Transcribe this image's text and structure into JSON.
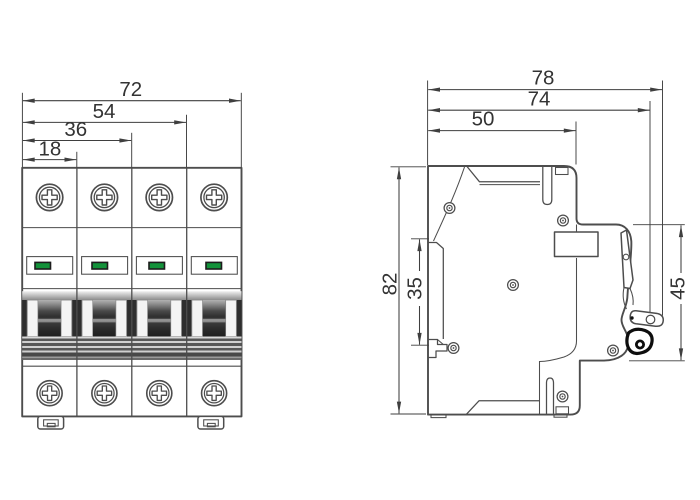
{
  "front_view": {
    "dimensions": {
      "total_width": "72",
      "three_pole_width": "54",
      "two_pole_width": "36",
      "one_pole_width": "18"
    },
    "pole_count": 4
  },
  "side_view": {
    "dimensions": {
      "total_depth": "78",
      "depth_to_lever_pivot": "74",
      "base_depth": "50",
      "total_height": "82",
      "din_slot_height": "35",
      "front_face_height": "45"
    }
  },
  "colors": {
    "line": "#4d4d4d",
    "dim_line": "#3f3f3f",
    "text": "#333333",
    "indicator_green": "#13923a",
    "indicator_border": "#1c1c1c",
    "toggle_dark": "#2e2e2e",
    "background": "#ffffff"
  }
}
